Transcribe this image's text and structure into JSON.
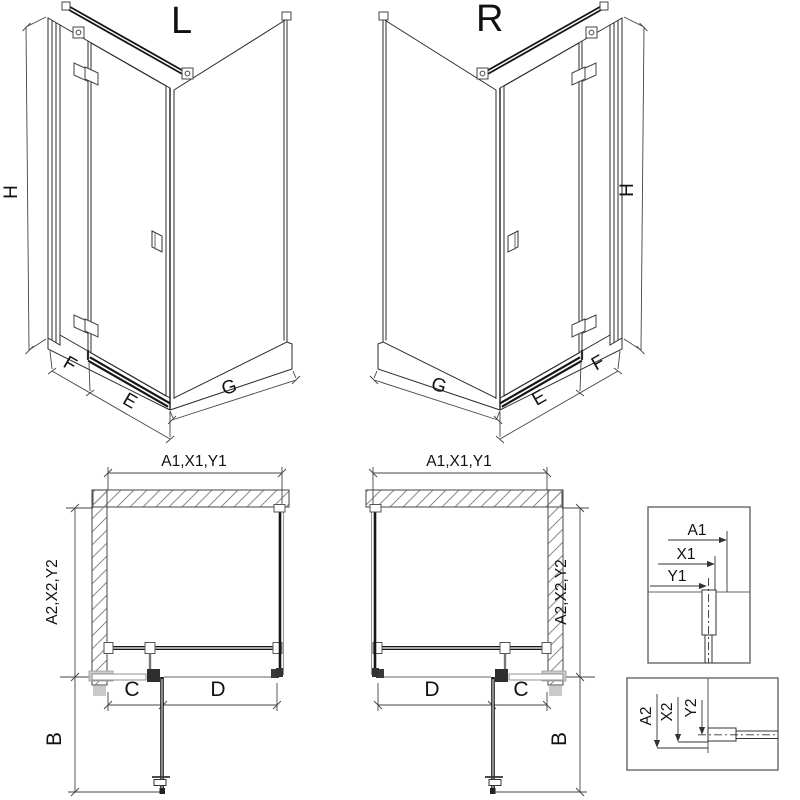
{
  "iso_left": {
    "title": "L",
    "height": "H",
    "panel_f": "F",
    "panel_e": "E",
    "panel_g": "G"
  },
  "iso_right": {
    "title": "R",
    "height": "H",
    "panel_f": "F",
    "panel_e": "E",
    "panel_g": "G"
  },
  "plan_left": {
    "width": "A1,X1,Y1",
    "depth": "A2,X2,Y2",
    "seg_c": "C",
    "seg_d": "D",
    "swing": "B"
  },
  "plan_right": {
    "width": "A1,X1,Y1",
    "depth": "A2,X2,Y2",
    "seg_c": "C",
    "seg_d": "D",
    "swing": "B"
  },
  "detail_top": {
    "a": "A1",
    "x": "X1",
    "y": "Y1"
  },
  "detail_bottom": {
    "a": "A2",
    "x": "X2",
    "y": "Y2"
  },
  "colors": {
    "line": "#2b2b2b",
    "dim": "#444444",
    "dark": "#161616",
    "hatch": "#8a8a8a",
    "gray_fill": "#c9c9c9"
  }
}
